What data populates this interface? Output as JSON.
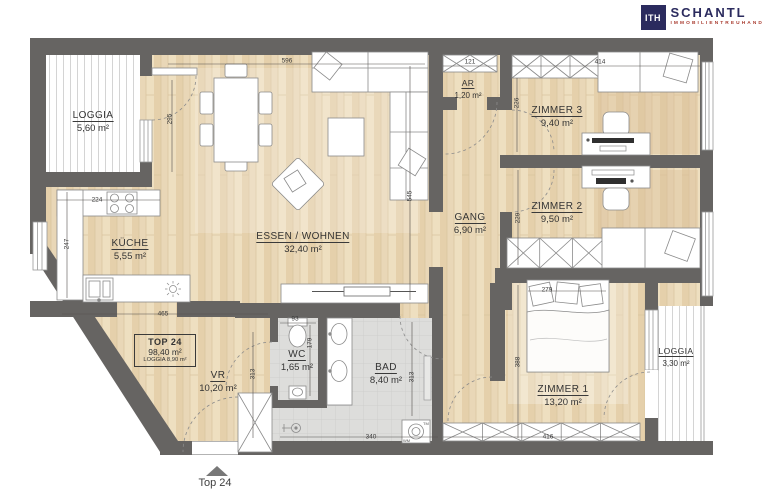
{
  "brand": {
    "monogram": "ITH",
    "name": "SCHANTL",
    "tagline": "IMMOBILIENTREUHAND"
  },
  "unit": {
    "label": "TOP 24",
    "total_area": "98,40 m²",
    "loggia_area": "LOGGIA 8,90 m²",
    "entrance_label": "Top 24"
  },
  "rooms": [
    {
      "name": "LOGGIA",
      "area": "5,60 m²"
    },
    {
      "name": "KÜCHE",
      "area": "5,55 m²"
    },
    {
      "name": "ESSEN / WOHNEN",
      "area": "32,40 m²"
    },
    {
      "name": "AR",
      "area": "1,20 m²"
    },
    {
      "name": "ZIMMER 3",
      "area": "9,40 m²"
    },
    {
      "name": "GANG",
      "area": "6,90 m²"
    },
    {
      "name": "ZIMMER 2",
      "area": "9,50 m²"
    },
    {
      "name": "VR",
      "area": "10,20 m²"
    },
    {
      "name": "WC",
      "area": "1,65 m²"
    },
    {
      "name": "BAD",
      "area": "8,40 m²"
    },
    {
      "name": "ZIMMER 1",
      "area": "13,20 m²"
    },
    {
      "name": "LOGGIA",
      "area": "3,30 m²"
    }
  ],
  "dims": [
    "596",
    "295",
    "545",
    "224",
    "247",
    "465",
    "121",
    "414",
    "226",
    "229",
    "279",
    "388",
    "416",
    "313",
    "313",
    "93",
    "179",
    "340"
  ],
  "appliances": {
    "washer": "WM",
    "dryer": "TM"
  },
  "colors": {
    "wall": "#666462",
    "wood_floor": "#e9d7b7",
    "tile_floor": "#dddddb",
    "brand_navy": "#2b2b5e",
    "brand_red": "#aa3d31"
  }
}
